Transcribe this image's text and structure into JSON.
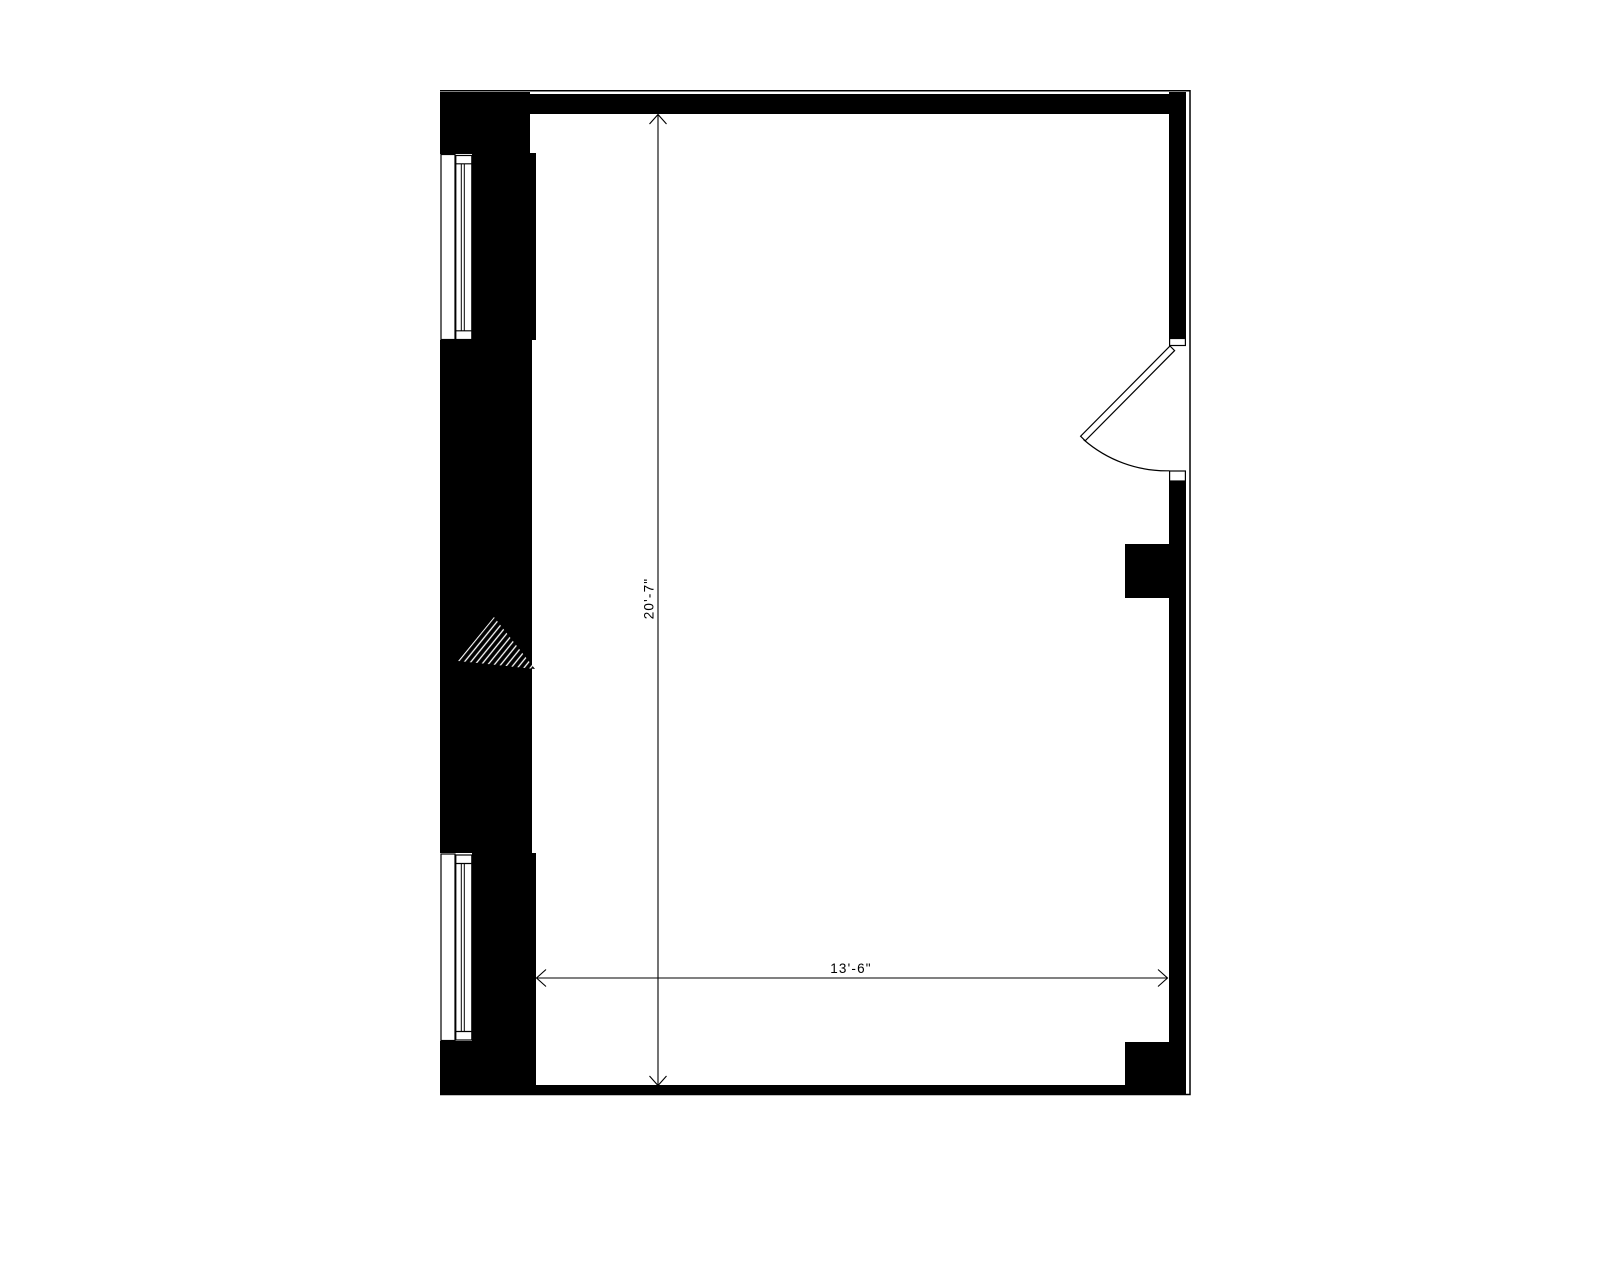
{
  "plan": {
    "background_color": "#ffffff",
    "wall_color": "#000000",
    "line_color": "#000000",
    "dimensions": {
      "vertical_label": "20'-7\"",
      "horizontal_label": "13'-6\""
    }
  }
}
